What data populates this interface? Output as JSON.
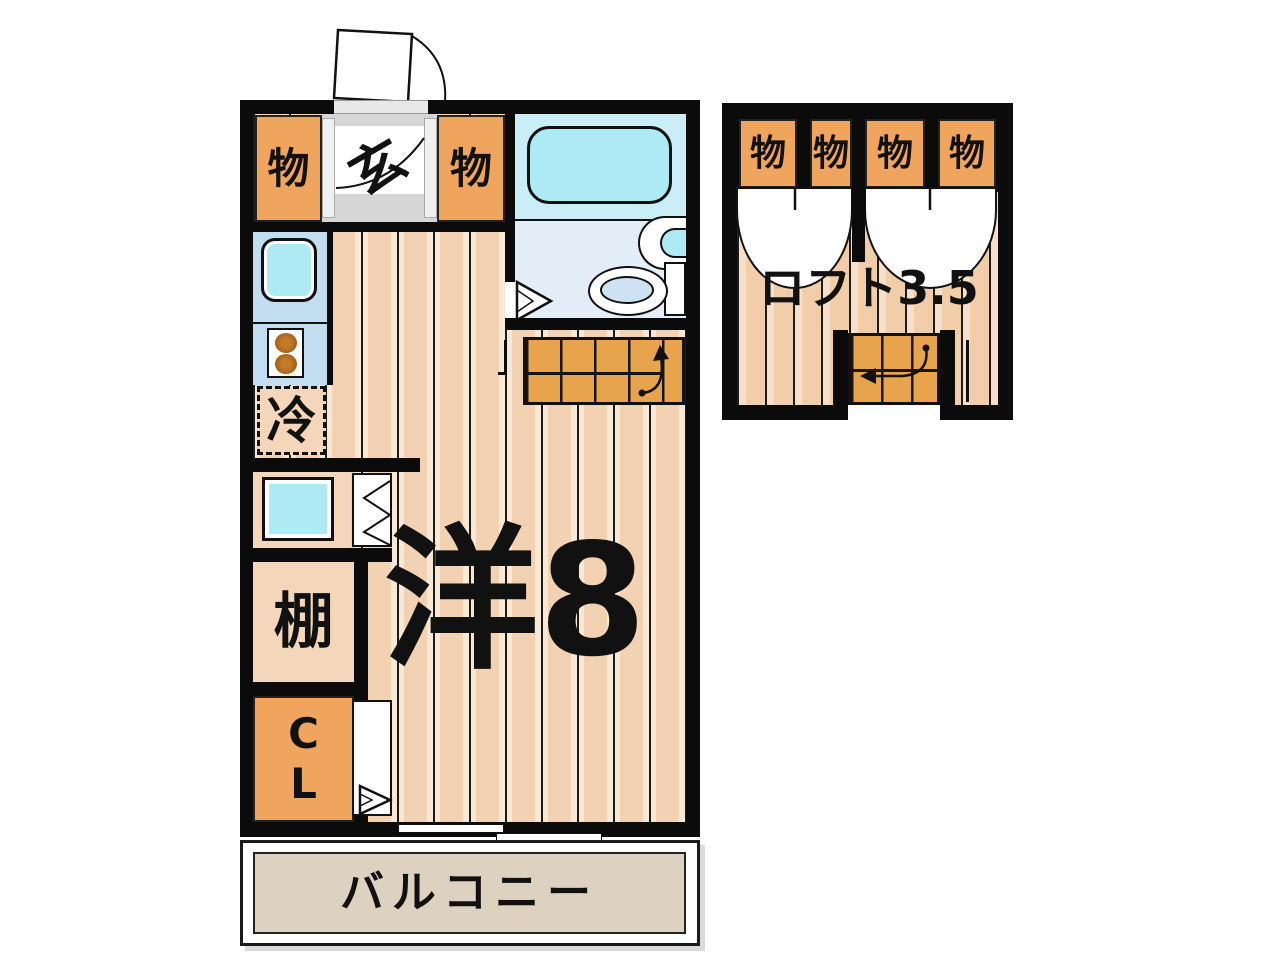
{
  "plan": {
    "main": {
      "storage_left": "物",
      "genkan": "玄",
      "storage_right": "物",
      "refrigerator": "冷",
      "shelf": "棚",
      "closet_line1": "C",
      "closet_line2": "L",
      "room": "洋8",
      "balcony": "バルコニー"
    },
    "loft": {
      "label": "ロフト3.5",
      "storage_1": "物",
      "storage_2": "物",
      "storage_3": "物",
      "storage_4": "物"
    }
  },
  "colors": {
    "wall": "#0b0b0b",
    "floor-panel": "#f3d2b3",
    "floor-highlight": "#fae8d6",
    "orange": "#f0a55e",
    "stairs": "#e8a44c",
    "balcony": "#ddd2bf",
    "bath-upper": "#c9eef7",
    "bath-lower": "#e3edf8",
    "fixture-cyan": "#aeeaf4",
    "kitchen-blue": "#c2dcf0",
    "genkan-gray": "#d6d6d6",
    "burner-brown": "#a5601c",
    "toilet-blue": "#cfe2f4",
    "room-peach": "#f4d6ba"
  }
}
